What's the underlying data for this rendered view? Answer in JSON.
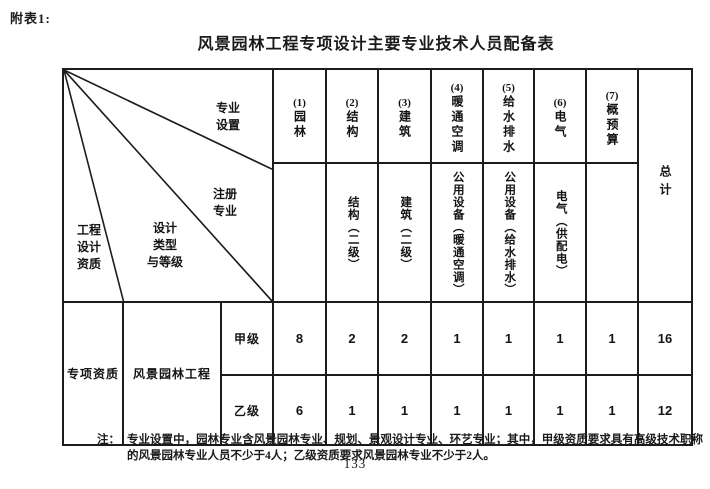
{
  "page": {
    "corner_label": "附表1:",
    "title": "风景园林工程专项设计主要专业技术人员配备表",
    "note_label": "注：",
    "note_text": "专业设置中，园林专业含风景园林专业、规划、景观设计专业、环艺专业；其中，甲级资质要求具有高级技术职称的风景园林专业人员不少于4人；乙级资质要求风景园林专业不少于2人。",
    "page_number": "133"
  },
  "table": {
    "corner": {
      "major_setup": "专业\n设置",
      "registered_major": "注册\n专业",
      "design_type_grade": "设计\n类型\n与等级",
      "engineering_qualification": "工程\n设计\n资质"
    },
    "columns": [
      {
        "number": "(1)",
        "major": "园林",
        "registered": ""
      },
      {
        "number": "(2)",
        "major": "结构",
        "registered": "结构（二级）"
      },
      {
        "number": "(3)",
        "major": "建筑",
        "registered": "建筑（二级）"
      },
      {
        "number": "(4)",
        "major": "暖通空调",
        "registered": "公用设备（暖通空调）"
      },
      {
        "number": "(5)",
        "major": "给水排水",
        "registered": "公用设备（给水排水）"
      },
      {
        "number": "(6)",
        "major": "电气",
        "registered": "电气（供配电）"
      },
      {
        "number": "(7)",
        "major": "概预算",
        "registered": ""
      }
    ],
    "total_header": "总计",
    "rows": [
      {
        "qualification": "专项资质",
        "design_type": "风景园林工程",
        "grade": "甲级",
        "values": [
          "8",
          "2",
          "2",
          "1",
          "1",
          "1",
          "1"
        ],
        "total": "16"
      },
      {
        "grade": "乙级",
        "values": [
          "6",
          "1",
          "1",
          "1",
          "1",
          "1",
          "1"
        ],
        "total": "12"
      }
    ]
  }
}
